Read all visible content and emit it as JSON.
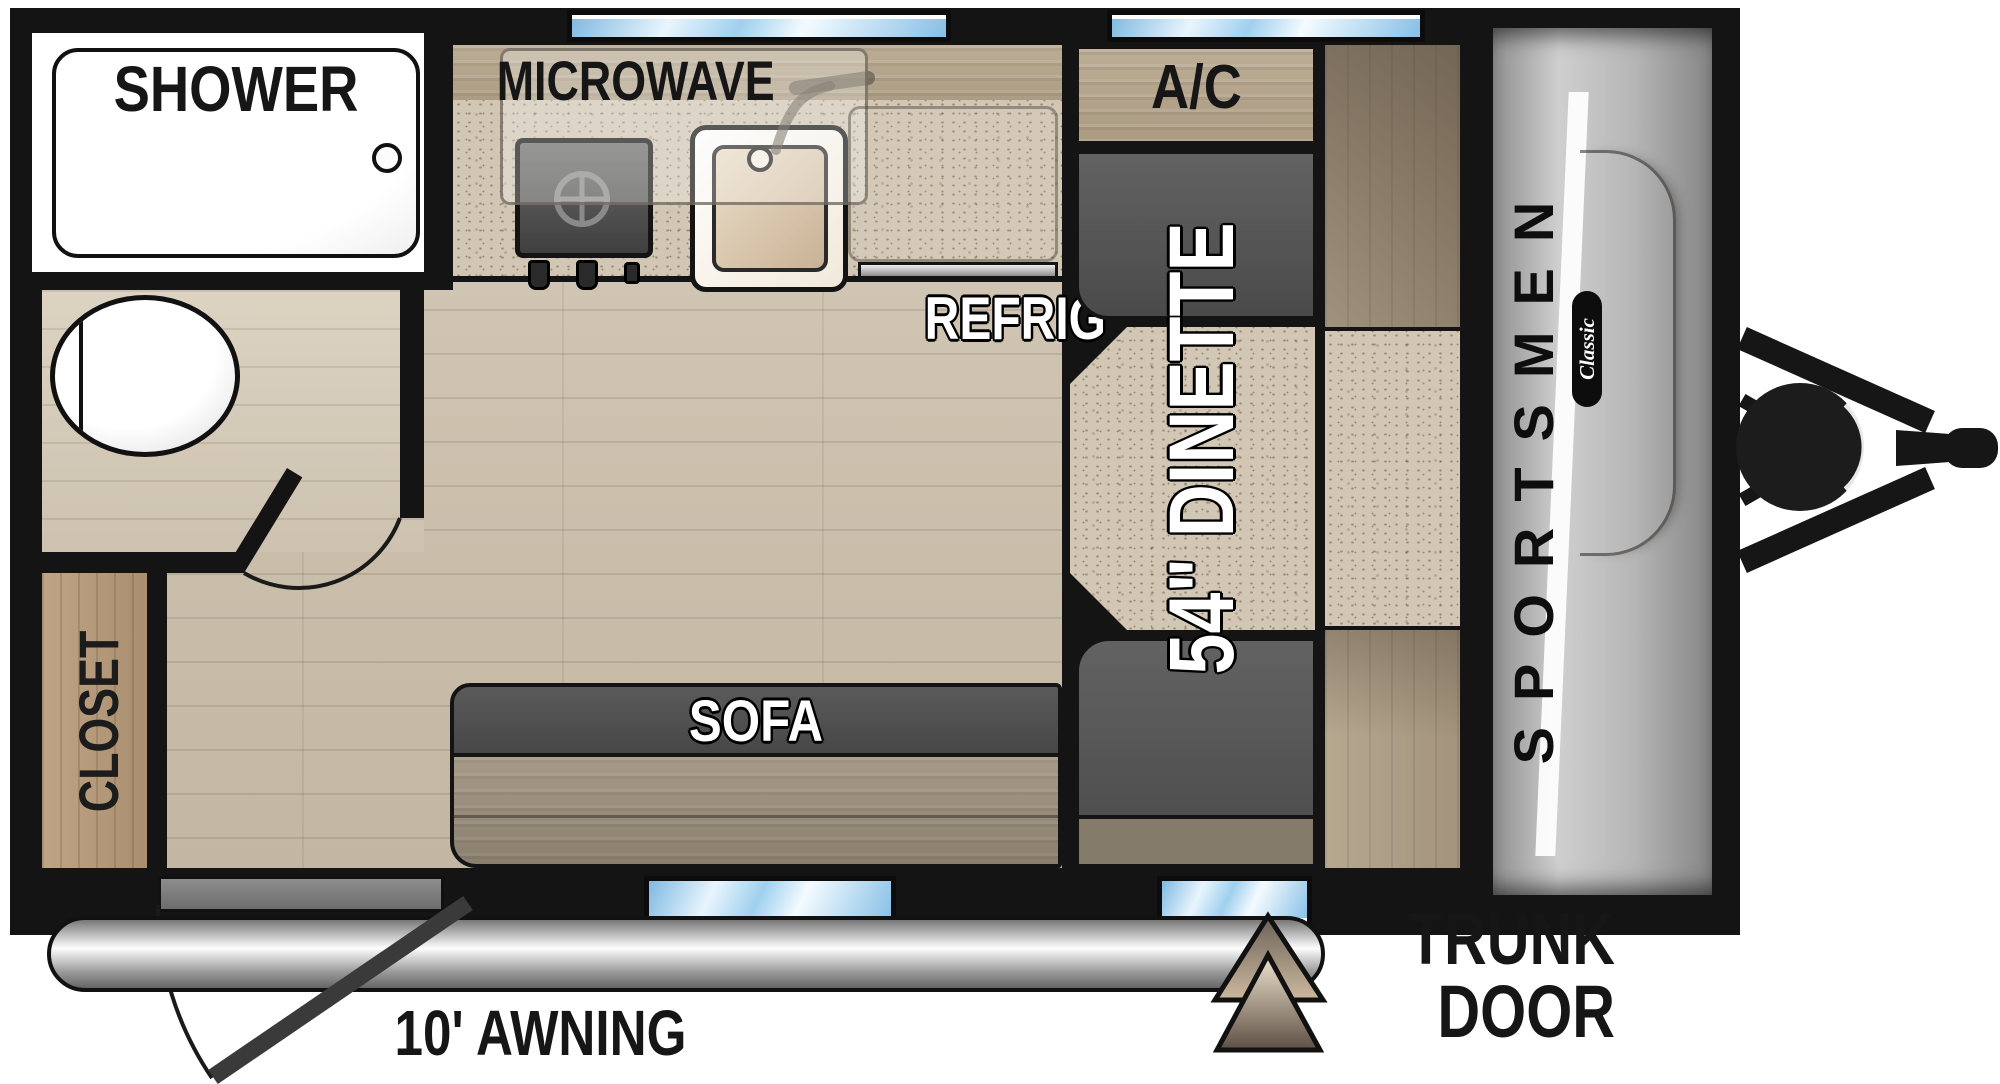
{
  "title": "Sportsmen Classic travel trailer floor plan",
  "brand": {
    "name": "SPORTSMEN",
    "series": "Classic"
  },
  "labels": {
    "shower": "SHOWER",
    "microwave": "MICROWAVE",
    "ac": "A/C",
    "refrig": "REFRIG",
    "dinette": "54\" DINETTE",
    "sofa": "SOFA",
    "closet": "CLOSET",
    "awning": "10' AWNING",
    "trunk_line1": "TRUNK",
    "trunk_line2": "DOOR"
  },
  "icons": {
    "toilet": "oval-top-view",
    "sink": "rounded-square-basin",
    "faucet": "curved-spout",
    "stove": "burner-unit",
    "drain": "small-circle",
    "entry_door": "swing-arc",
    "bathroom_door": "swing-arc",
    "awning": "roller-tube-bar",
    "trunk_door": "double-triangle-marker",
    "propane_tank": "filled-circle",
    "hitch": "a-frame-with-coupler",
    "windows": "blue-glass-strips"
  },
  "colors": {
    "wall": "#141414",
    "window_glass": "#9fd0ee",
    "floor": "#cdc2b0",
    "bathroom_floor": "#d8cfbe",
    "cabinet_wood": "#b6a78f",
    "closet_wood": "#b29876",
    "granite_counter": "#d2c7b5",
    "dinette_seat": "#565656",
    "sofa_back": "#4f4f4f",
    "sofa_seat": "#a19683",
    "front_cap": "#b5b5b5",
    "entry_step": "#7d7d7d",
    "awning_tube": "#cccccc",
    "trunk_triangle_light": "#ead9c2",
    "trunk_triangle_dark": "#655a4c",
    "label_dark": "#161616",
    "label_light": "#ffffff"
  }
}
